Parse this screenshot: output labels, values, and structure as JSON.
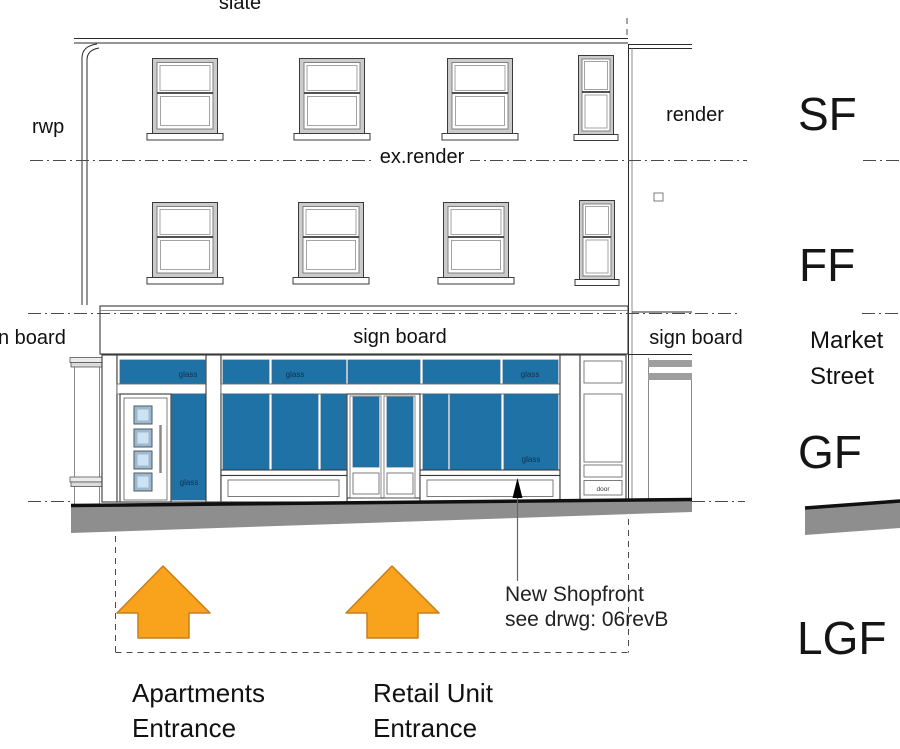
{
  "colors": {
    "glass_blue": "#1E72A6",
    "glass_label": "#12314f",
    "pavement_gray": "#8E8E8E",
    "molding_gray": "#9E9E9E",
    "arrow_orange": "#F9A21B",
    "arrow_border": "#C77F1C",
    "door_glass": "#CCE2F5",
    "door_glass_frame": "#9FB9CC"
  },
  "labels": {
    "slate": "slate",
    "rwp": "rwp",
    "ex_render": "ex.render",
    "render": "render",
    "glass": "glass",
    "door": "door"
  },
  "signboard": {
    "left": "n board",
    "center": "sign board",
    "right": "sign board"
  },
  "street": {
    "line1": "Market",
    "line2": "Street"
  },
  "floors": {
    "sf": "SF",
    "ff": "FF",
    "gf": "GF",
    "lgf": "LGF"
  },
  "note": {
    "line1": "New Shopfront",
    "line2": "see drwg: 06revB"
  },
  "entrances": {
    "apartments": {
      "line1": "Apartments",
      "line2": "Entrance"
    },
    "retail": {
      "line1": "Retail Unit",
      "line2": "Entrance"
    }
  }
}
